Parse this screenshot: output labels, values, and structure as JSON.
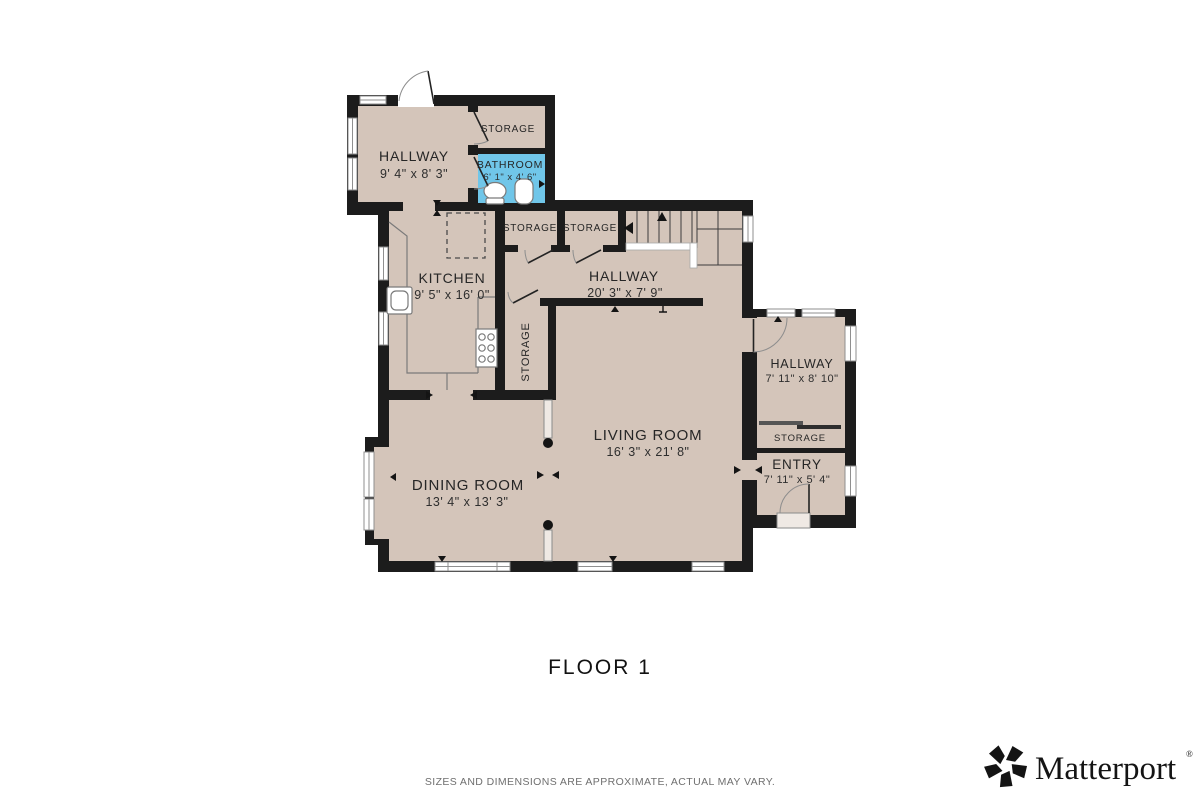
{
  "floor_plan": {
    "title": "FLOOR 1",
    "disclaimer": "SIZES AND DIMENSIONS ARE APPROXIMATE, ACTUAL MAY VARY.",
    "brand": {
      "name": "Matterport",
      "registered": "®"
    },
    "colors": {
      "floor": "#d4c5ba",
      "bathroom": "#70c6e9",
      "wall": "#1c1c1c",
      "window_line": "#8f8f8f",
      "fixture_line": "#7a7a7a",
      "text": "#262626",
      "muted_text": "#6f6f6f"
    },
    "rooms": [
      {
        "id": "hallway-nw",
        "name": "HALLWAY",
        "dims": "9' 4\" x 8' 3\""
      },
      {
        "id": "storage-nw",
        "name": "STORAGE",
        "dims": ""
      },
      {
        "id": "bathroom",
        "name": "BATHROOM",
        "dims": "6' 1\" x 4' 6\""
      },
      {
        "id": "storage-a",
        "name": "STORAGE",
        "dims": ""
      },
      {
        "id": "storage-b",
        "name": "STORAGE",
        "dims": ""
      },
      {
        "id": "kitchen",
        "name": "KITCHEN",
        "dims": "9' 5\" x 16' 0\""
      },
      {
        "id": "hallway-main",
        "name": "HALLWAY",
        "dims": "20' 3\" x 7' 9\""
      },
      {
        "id": "storage-tall",
        "name": "STORAGE",
        "dims": ""
      },
      {
        "id": "living-room",
        "name": "LIVING ROOM",
        "dims": "16' 3\" x 21' 8\""
      },
      {
        "id": "dining-room",
        "name": "DINING ROOM",
        "dims": "13' 4\" x 13' 3\""
      },
      {
        "id": "hallway-e",
        "name": "HALLWAY",
        "dims": "7' 11\" x 8' 10\""
      },
      {
        "id": "storage-e",
        "name": "STORAGE",
        "dims": ""
      },
      {
        "id": "entry",
        "name": "ENTRY",
        "dims": "7' 11\" x 5' 4\""
      }
    ]
  }
}
